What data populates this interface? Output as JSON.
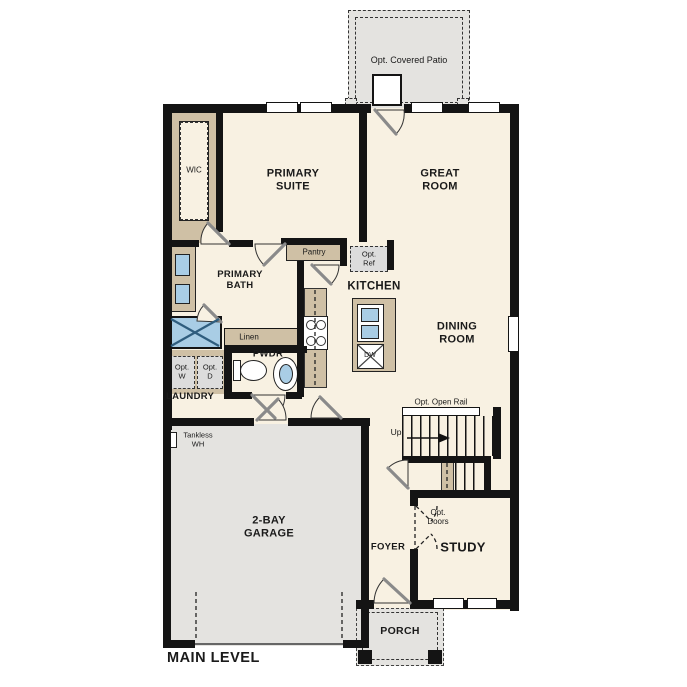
{
  "title": "MAIN LEVEL",
  "colors": {
    "floor": "#f8f1e2",
    "hardscape": "#e4e3e0",
    "wall": "#141414",
    "cabinet_tan": "#cfc0a5",
    "fixture_blue": "#a9cde5"
  },
  "rooms": {
    "patio": "Opt. Covered Patio",
    "wic": "WIC",
    "primary_suite": "PRIMARY\nSUITE",
    "great_room": "GREAT\nROOM",
    "primary_bath": "PRIMARY\nBATH",
    "kitchen": "KITCHEN",
    "dining_room": "DINING\nROOM",
    "pwdr": "PWDR",
    "laundry": "LAUNDRY",
    "garage": "2-BAY\nGARAGE",
    "foyer": "FOYER",
    "study": "STUDY",
    "porch": "PORCH"
  },
  "features": {
    "pantry": "Pantry",
    "opt_ref": "Opt.\nRef",
    "linen": "Linen",
    "opt_w": "Opt.\nW",
    "opt_d": "Opt.\nD",
    "tankless_wh": "Tankless\nWH",
    "opt_open_rail": "Opt. Open Rail",
    "up": "Up",
    "opt_doors": "Opt.\nDoors",
    "dw": "DW"
  }
}
